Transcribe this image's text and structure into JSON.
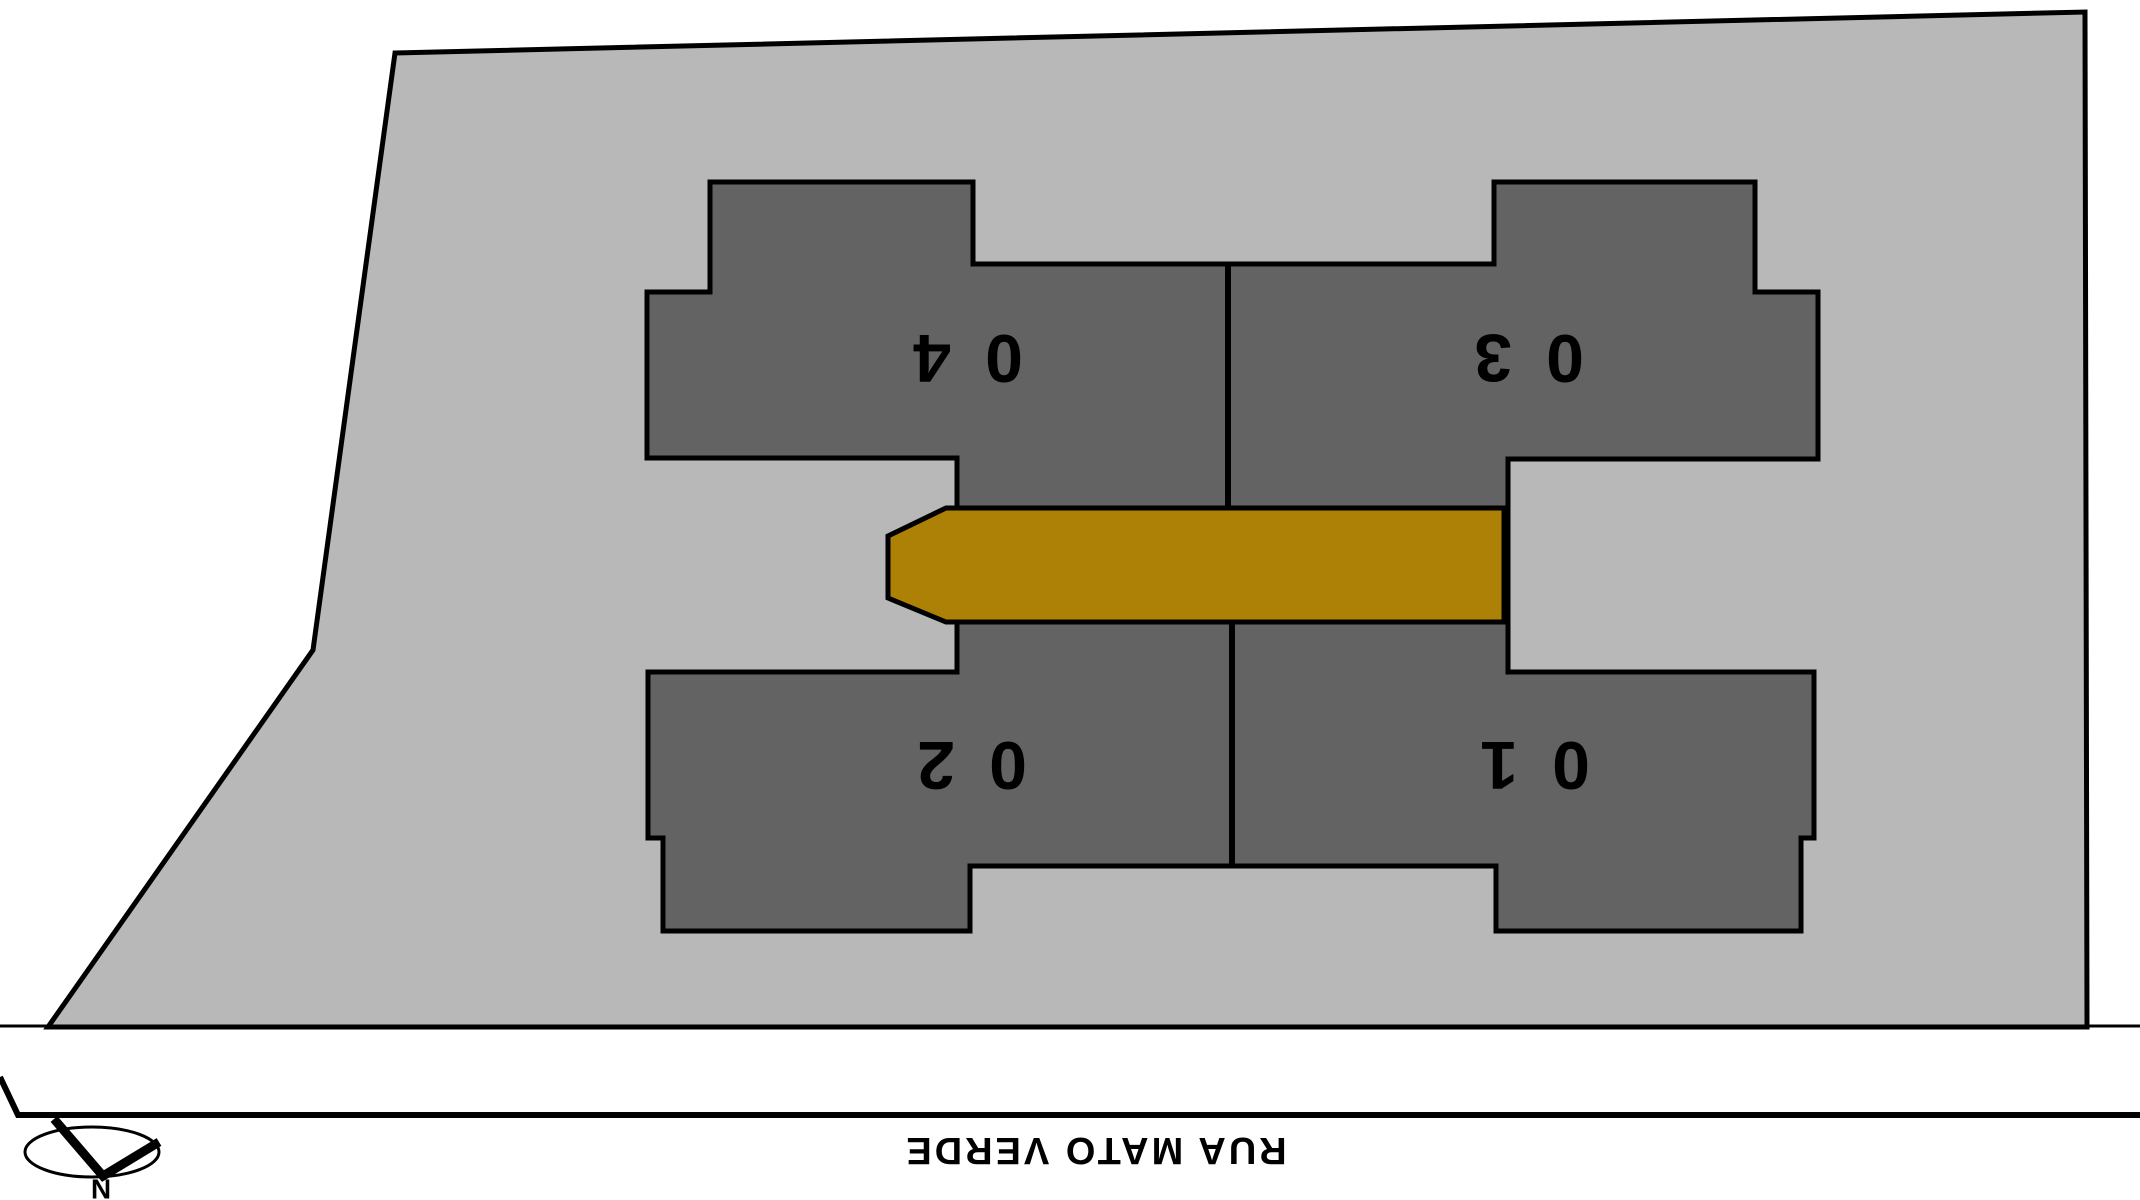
{
  "plan": {
    "title": "site-implantation-plan",
    "units": [
      {
        "label": "01"
      },
      {
        "label": "02"
      },
      {
        "label": "03"
      },
      {
        "label": "04"
      }
    ],
    "street": {
      "name": "RUA MATO VERDE"
    },
    "compass": {
      "label": "N"
    },
    "colors": {
      "background": "#ffffff",
      "lot": "#b8b8b8",
      "building": "#636363",
      "corridor": "#ad8106",
      "outline": "#000000"
    }
  }
}
